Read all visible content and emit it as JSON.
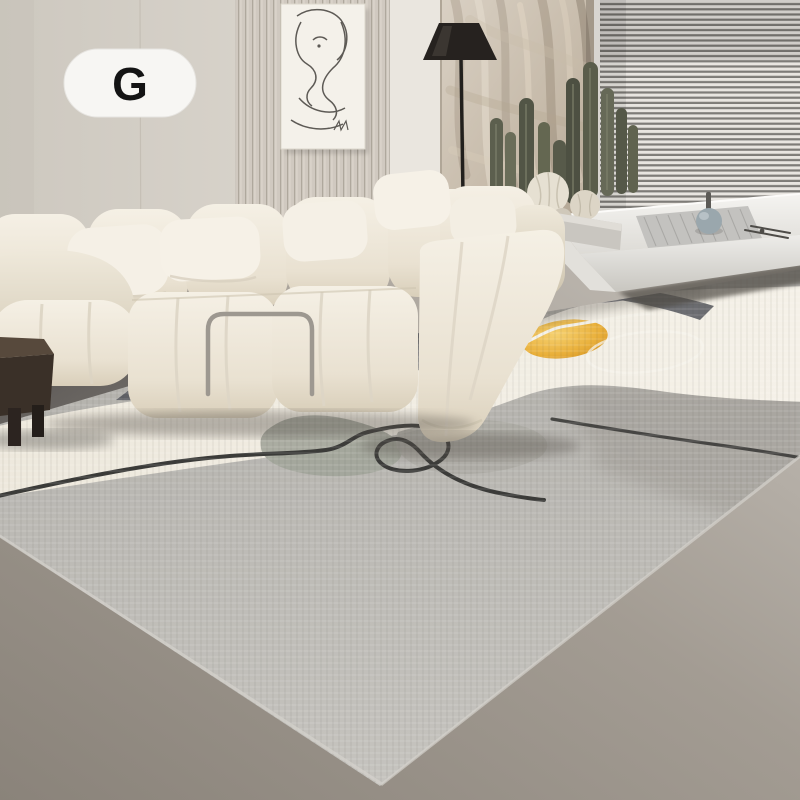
{
  "badge": {
    "label": "G"
  },
  "scene": {
    "type": "product-photo",
    "subject": "abstract-area-rug-in-living-room",
    "objects": [
      "variant-label-badge-G",
      "fluted-wall-panel",
      "abstract-line-art-canvas",
      "black-cone-floor-lamp",
      "textured-stone-mural-wall",
      "venetian-blinds-window",
      "cactus-planter-garden",
      "white-platform-bench",
      "gray-placemat",
      "blue-gray-vase",
      "cream-modular-sofa",
      "white-lumbar-pillows",
      "metal-armrest-handle",
      "dark-wood-side-table",
      "abstract-gray-cream-rug",
      "golden-circle-motif",
      "black-squiggle-lines"
    ],
    "colors": {
      "wall": "#d9d4cb",
      "wall_bright": "#e9e5de",
      "floor": "#978f85",
      "floor_left": "#67635d",
      "sofa_ivory": "#eee8da",
      "pillow_white": "#f5f0e6",
      "rug_charcoal": "#5b5c60",
      "rug_light_gray": "#bab8b3",
      "rug_cream": "#f0ebe0",
      "rug_olive": "#a2a59a",
      "rug_gold": "#e2a432",
      "rug_line": "#3b3b39",
      "lamp_black": "#26221f",
      "cactus_green": "#5a5d4c",
      "wood_table": "#3a3028",
      "vase_blue_gray": "#9aa7ad"
    }
  }
}
